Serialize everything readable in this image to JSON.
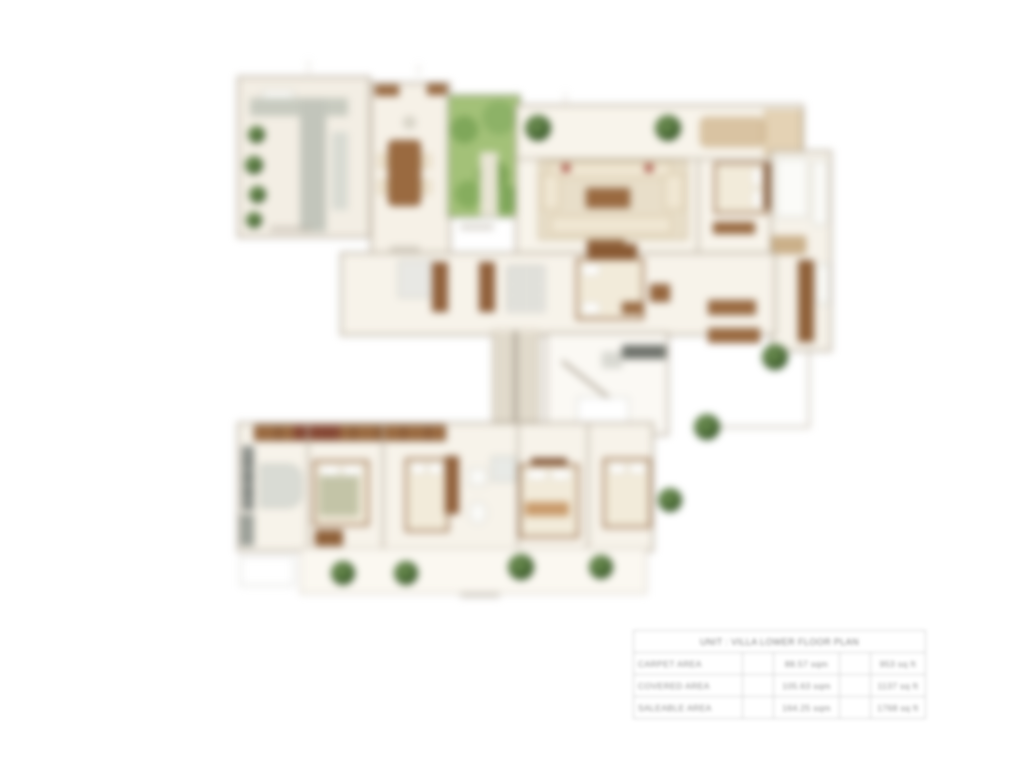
{
  "page": {
    "background": "#ffffff",
    "content_type": "villa lower floor plan rendering with area statement table"
  },
  "plan": {
    "palette": {
      "floor_cream": "#f6f1e7",
      "wall_gray": "#b3a897",
      "wood_brown": "#9a6a40",
      "wood_dark": "#7d5233",
      "terrace_tan": "#d9c3a2",
      "garden_green": "#a3c178",
      "plant_dark_green": "#3c5c2b",
      "stone_gray": "#c7cabf",
      "appliance_gray": "#82867f",
      "accent_red": "#a85146"
    }
  },
  "area_table": {
    "title": "UNIT : VILLA LOWER FLOOR PLAN",
    "rows": [
      {
        "label": "CARPET AREA",
        "metric": "88.57 sqm",
        "imperial": "953 sq ft"
      },
      {
        "label": "COVERED AREA",
        "metric": "105.63 sqm",
        "imperial": "1137 sq ft"
      },
      {
        "label": "SALEABLE AREA",
        "metric": "164.25 sqm",
        "imperial": "1768 sq ft"
      }
    ]
  }
}
